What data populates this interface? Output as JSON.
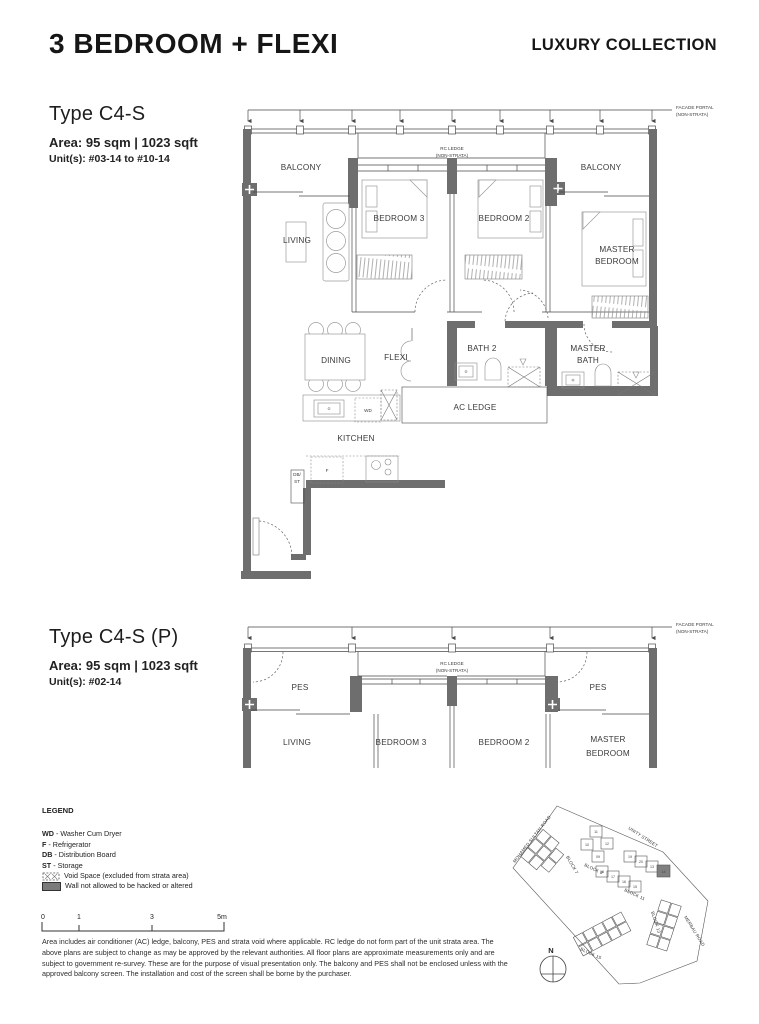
{
  "header": {
    "title": "3 BEDROOM + FLEXI",
    "collection": "LUXURY COLLECTION"
  },
  "plan1": {
    "name": "Type C4-S",
    "area": "Area: 95 sqm | 1023 sqft",
    "units": "Unit(s): #03-14 to #10-14",
    "facade_portal": [
      "FACADE PORTAL",
      "(NON-STRATA)"
    ],
    "rc_ledge": [
      "RC LEDGE",
      "(NON-STRATA)"
    ],
    "rooms": {
      "balcony_left": "BALCONY",
      "balcony_right": "BALCONY",
      "living": "LIVING",
      "bedroom3": "BEDROOM 3",
      "bedroom2": "BEDROOM 2",
      "master_bedroom": [
        "MASTER",
        "BEDROOM"
      ],
      "dining": "DINING",
      "flexi": "FLEXI",
      "bath2": "BATH 2",
      "master_bath": [
        "MASTER",
        "BATH"
      ],
      "ac_ledge": "AC LEDGE",
      "kitchen": "KITCHEN",
      "wd": "WD",
      "f": "F",
      "db_st": [
        "DB/",
        "ST"
      ]
    }
  },
  "plan2": {
    "name": "Type C4-S (P)",
    "area": "Area: 95 sqm | 1023 sqft",
    "units": "Unit(s): #02-14",
    "facade_portal": [
      "FACADE PORTAL",
      "(NON-STRATA)"
    ],
    "rc_ledge": [
      "RC LEDGE",
      "(NON-STRATA)"
    ],
    "rooms": {
      "pes_left": "PES",
      "pes_right": "PES",
      "living": "LIVING",
      "bedroom3": "BEDROOM 3",
      "bedroom2": "BEDROOM 2",
      "master_bedroom": [
        "MASTER",
        "BEDROOM"
      ]
    }
  },
  "legend": {
    "title": "LEGEND",
    "items": [
      {
        "abbr": "WD",
        "desc": "- Washer Cum Dryer"
      },
      {
        "abbr": "F",
        "desc": "- Refrigerator"
      },
      {
        "abbr": "DB",
        "desc": "- Distribution Board"
      },
      {
        "abbr": "ST",
        "desc": "- Storage"
      }
    ],
    "void_space": "Void Space (excluded from strata area)",
    "wall": "Wall not allowed to be hacked or altered"
  },
  "scale_bar": {
    "ticks": [
      "0",
      "1",
      "3",
      "5m"
    ]
  },
  "disclaimer": "Area includes air conditioner (AC) ledge, balcony, PES and strata void where applicable. RC ledge do not form part of the unit strata area. The above plans are subject to change as may be approved by the relevant authorities. All floor plans are approximate measurements only and are subject to government re-survey. These are for the purpose of visual presentation only. The balcony and PES shall not be enclosed unless with the approved balcony screen. The installation and cost of the screen shall be borne by the purchaser.",
  "site_map": {
    "roads": [
      "MOHAMED SULTAN ROAD",
      "UNITY STREET",
      "MERBAU ROAD"
    ],
    "blocks": [
      "BLOCK 7",
      "BLOCK 9",
      "BLOCK 11",
      "BLOCK 13",
      "BLOCK 15"
    ],
    "compass": "N",
    "highlighted_unit": "14",
    "block9_units": [
      "11",
      "12",
      "10",
      "09"
    ],
    "block11_units_upper": [
      "19",
      "20",
      "13"
    ],
    "block11_units_lower": [
      "18",
      "17",
      "16",
      "15"
    ]
  },
  "colors": {
    "wall": "#6e6e6e",
    "text": "#2c2c2c",
    "highlight": "#7f7f7f"
  }
}
